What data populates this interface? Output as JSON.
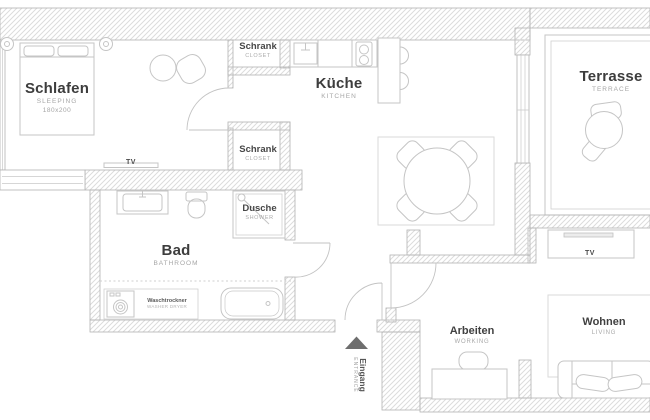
{
  "plan": {
    "rooms": {
      "schlafen": {
        "name": "Schlafen",
        "sub": "SLEEPING",
        "size": "180x200"
      },
      "schrank_top": {
        "name": "Schrank",
        "sub": "CLOSET"
      },
      "schrank_bottom": {
        "name": "Schrank",
        "sub": "CLOSET"
      },
      "kueche": {
        "name": "Küche",
        "sub": "KITCHEN"
      },
      "terrasse": {
        "name": "Terrasse",
        "sub": "TERRACE"
      },
      "bad": {
        "name": "Bad",
        "sub": "BATHROOM"
      },
      "dusche": {
        "name": "Dusche",
        "sub": "SHOWER"
      },
      "arbeiten": {
        "name": "Arbeiten",
        "sub": "WORKING"
      },
      "wohnen": {
        "name": "Wohnen",
        "sub": "LIVING"
      },
      "eingang": {
        "name": "Eingang",
        "sub": "ENTRANCE"
      }
    },
    "fixtures": {
      "tv_bedroom": "TV",
      "tv_living": "TV",
      "washer": {
        "name": "Waschtrockner",
        "sub": "WASHER DRYER"
      }
    },
    "colors": {
      "wall_stroke": "#b3b3b3",
      "hatch_line": "#dcdcdc",
      "furniture_stroke": "#c5c5c5",
      "label_primary": "#3d3d3d",
      "label_secondary": "#a6a6a6",
      "entrance_arrow": "#6e6e6e"
    }
  }
}
